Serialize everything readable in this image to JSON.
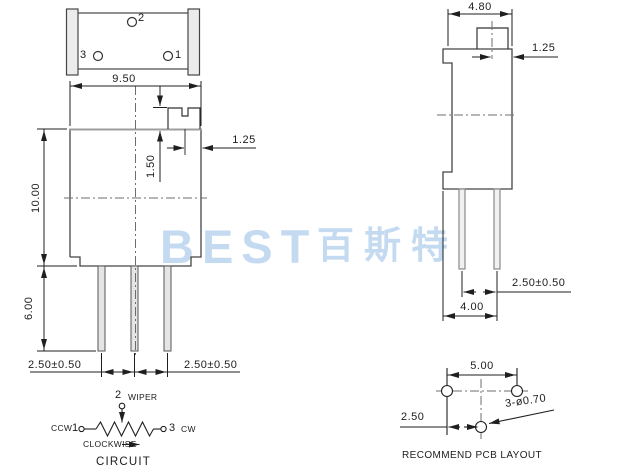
{
  "watermark": {
    "logo": "BEST",
    "cjk": "百斯特"
  },
  "top_view": {
    "pin_top": "2",
    "pin_left": "3",
    "pin_right": "1"
  },
  "front_view": {
    "body_width": "9.50",
    "screw_height": "1.50",
    "slot_offset": "1.25",
    "body_height": "10.00",
    "pin_length": "6.00",
    "pin_pitch_left": "2.50±0.50",
    "pin_pitch_right": "2.50±0.50"
  },
  "side_view": {
    "body_depth": "4.80",
    "slot_offset": "1.25",
    "pin_pitch": "2.50±0.50",
    "base_width": "4.00"
  },
  "circuit": {
    "pin2": "2",
    "wiper": "WIPER",
    "ccw": "CCW",
    "pin1": "1",
    "pin3": "3",
    "cw": "CW",
    "rotation": "CLOCKWISE",
    "title": "CIRCUIT"
  },
  "pcb_layout": {
    "hole_pitch_h": "5.00",
    "hole_offset": "2.50",
    "hole_spec": "3-ø0.70",
    "title": "RECOMMEND PCB LAYOUT"
  }
}
